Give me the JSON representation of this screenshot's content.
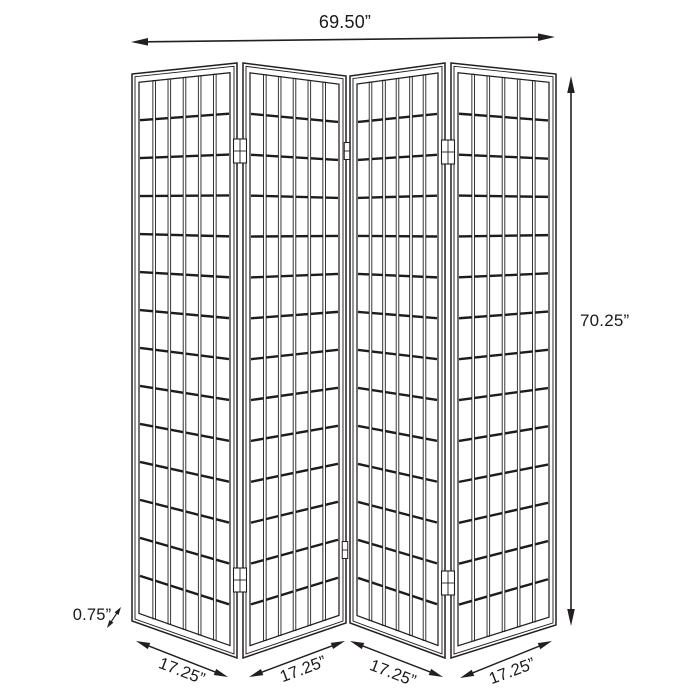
{
  "figure": {
    "type": "product-dimension-diagram",
    "subject": "four-panel-folding-screen",
    "background": "#ffffff",
    "line_color": "#231f20",
    "text_color": "#1a1a1c",
    "screen": {
      "panel_count": 4,
      "columns_per_panel": 6,
      "rows_per_panel": 14
    },
    "dimensions": {
      "overall_width": "69.50”",
      "overall_height": "70.25”",
      "frame_thickness": "0.75”",
      "panel_widths": [
        "17.25”",
        "17.25”",
        "17.25”",
        "17.25”"
      ]
    }
  }
}
